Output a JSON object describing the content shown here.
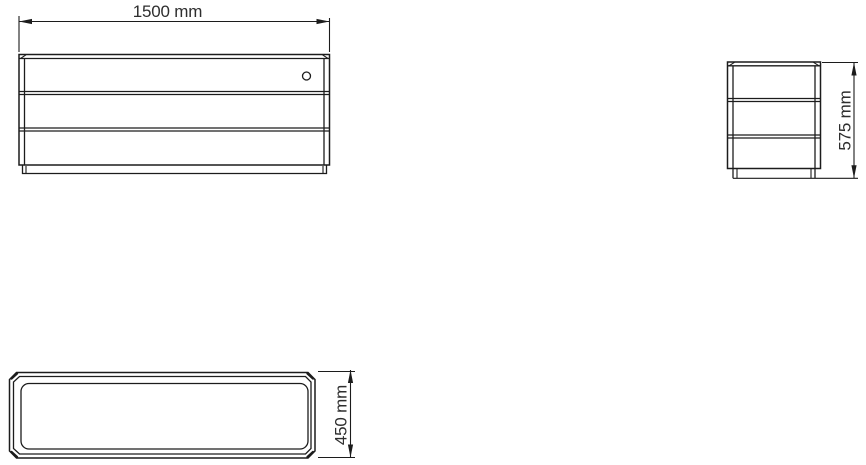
{
  "page": {
    "background": "#ffffff",
    "line_color": "#1c1c1c",
    "text_color": "#2e2e2e"
  },
  "drawing": {
    "type": "orthographic technical drawing",
    "subject": "three-drawer sideboard cabinet",
    "views": {
      "front": {
        "name": "front view",
        "dimension": {
          "label": "1500 mm",
          "value": 1500,
          "unit": "mm",
          "axis": "width"
        }
      },
      "side": {
        "name": "side view",
        "dimension": {
          "label": "575 mm",
          "value": 575,
          "unit": "mm",
          "axis": "height"
        }
      },
      "top": {
        "name": "top view",
        "dimension": {
          "label": "450 mm",
          "value": 450,
          "unit": "mm",
          "axis": "depth"
        }
      }
    }
  }
}
